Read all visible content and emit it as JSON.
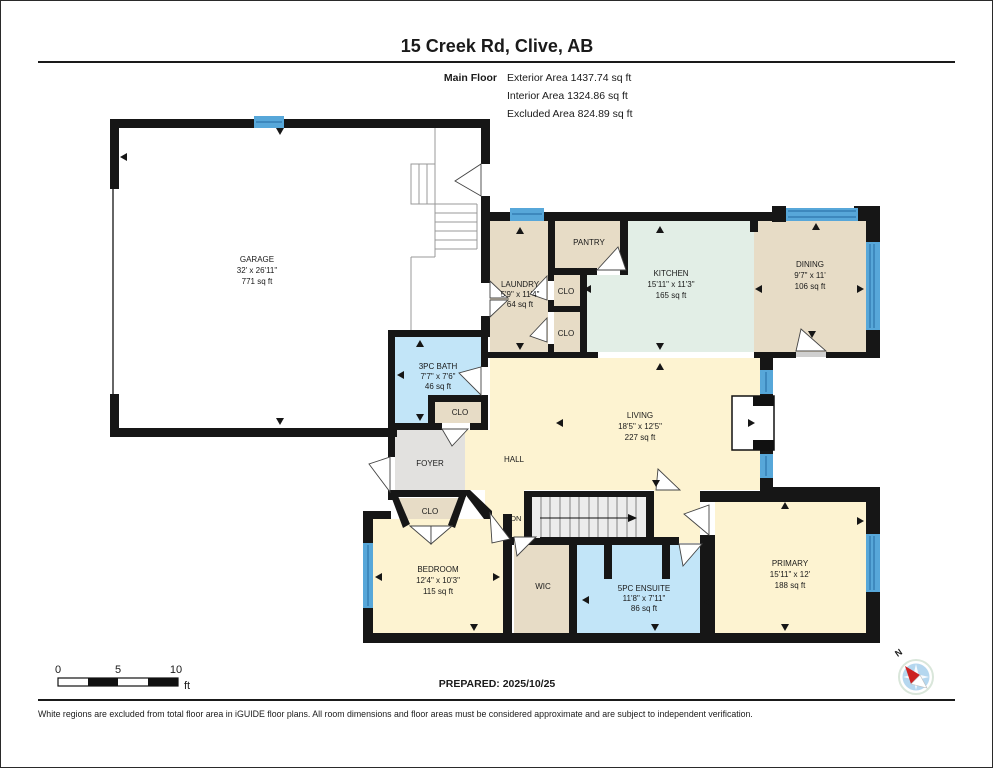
{
  "page": {
    "title": "15 Creek Rd, Clive, AB",
    "floor": {
      "label": "Main Floor",
      "exterior": "Exterior Area 1437.74 sq ft",
      "interior": "Interior Area 1324.86 sq ft",
      "excluded": "Excluded Area 824.89 sq ft"
    },
    "prepared": "PREPARED: 2025/10/25",
    "disclaimer": "White regions are excluded from total floor area in iGUIDE floor plans. All room dimensions and floor areas must be considered approximate and are subject to independent verification.",
    "compass": {
      "north": "N"
    }
  },
  "scale_bar": {
    "t0": "0",
    "t5": "5",
    "t10": "10",
    "unit": "ft"
  },
  "rooms": {
    "garage": {
      "name": "GARAGE",
      "dims": "32' x 26'11\"",
      "area": "771 sq ft"
    },
    "laundry": {
      "name": "LAUNDRY",
      "dims": "5'9\" x 11'4\"",
      "area": "64 sq ft"
    },
    "pantry": {
      "name": "PANTRY"
    },
    "closet_laundry_upper": {
      "name": "CLO"
    },
    "closet_laundry_lower": {
      "name": "CLO"
    },
    "kitchen": {
      "name": "KITCHEN",
      "dims": "15'11\" x 11'3\"",
      "area": "165 sq ft"
    },
    "dining": {
      "name": "DINING",
      "dims": "9'7\" x 11'",
      "area": "106 sq ft"
    },
    "bath_3pc": {
      "name": "3PC BATH",
      "dims": "7'7\" x 7'6\"",
      "area": "46 sq ft"
    },
    "closet_bath": {
      "name": "CLO"
    },
    "foyer": {
      "name": "FOYER"
    },
    "hall": {
      "name": "HALL"
    },
    "living": {
      "name": "LIVING",
      "dims": "18'5\" x 12'5\"",
      "area": "227 sq ft"
    },
    "closet_hall": {
      "name": "CLO"
    },
    "stairs": {
      "label": "DN"
    },
    "bedroom": {
      "name": "BEDROOM",
      "dims": "12'4\" x 10'3\"",
      "area": "115 sq ft"
    },
    "wic": {
      "name": "WIC"
    },
    "ensuite": {
      "name": "5PC ENSUITE",
      "dims": "11'8\" x 7'11\"",
      "area": "86 sq ft"
    },
    "primary": {
      "name": "PRIMARY",
      "dims": "15'11\" x 12'",
      "area": "188 sq ft"
    }
  },
  "colors": {
    "wall": "#161616",
    "beige": "#e7dcc6",
    "cream": "#fdf3d1",
    "kitchen": "#e2eee6",
    "bath_blue": "#c2e5f8",
    "foyer_gray": "#e2e1df",
    "window": "#57a7d9",
    "window_line": "#2e76ad",
    "stairs": "#ececec",
    "compass_face": "#b5d7ef",
    "compass_needle": "#cc2222"
  }
}
